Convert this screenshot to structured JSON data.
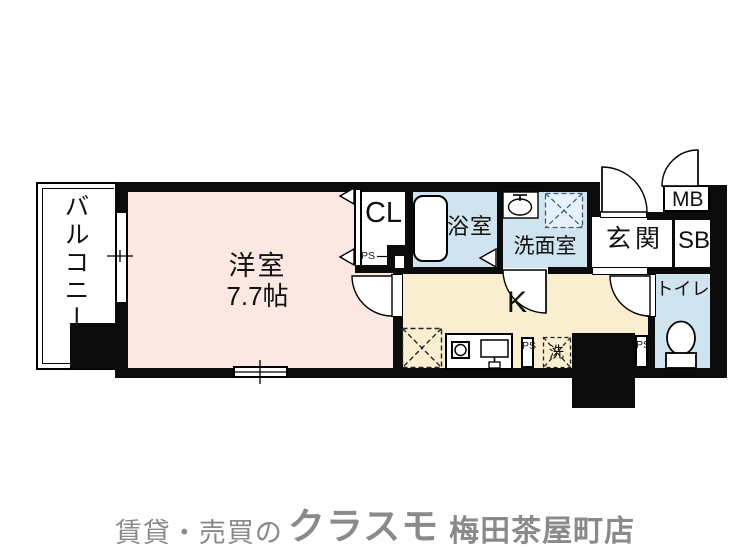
{
  "colors": {
    "wall": "#0b0b0b",
    "room_pink": "#fbe8e2",
    "room_blue": "#d0e4f0",
    "room_cream": "#f9eed0",
    "equip_box_blue": "#e7f1f9",
    "footer_gray": "#8a8a8a"
  },
  "plan": {
    "balcony": {
      "label": "バルコニー"
    },
    "western_room": {
      "label": "洋室",
      "size": "7.7帖"
    },
    "closet": {
      "label": "CL",
      "pipe_space": "PS"
    },
    "bathroom": {
      "label": "浴室"
    },
    "washroom": {
      "label": "洗面室"
    },
    "kitchen": {
      "label": "K",
      "pipe_space": "PS",
      "washing_machine": "洗"
    },
    "entrance": {
      "label": "玄関"
    },
    "shoe_box": {
      "label": "SB"
    },
    "meter_box": {
      "label": "MB"
    },
    "toilet": {
      "label": "トイレ",
      "pipe_space": "PS"
    }
  },
  "footer": {
    "prefix": "賃貸・売買の",
    "brand": "クラスモ",
    "store": "梅田茶屋町店"
  }
}
